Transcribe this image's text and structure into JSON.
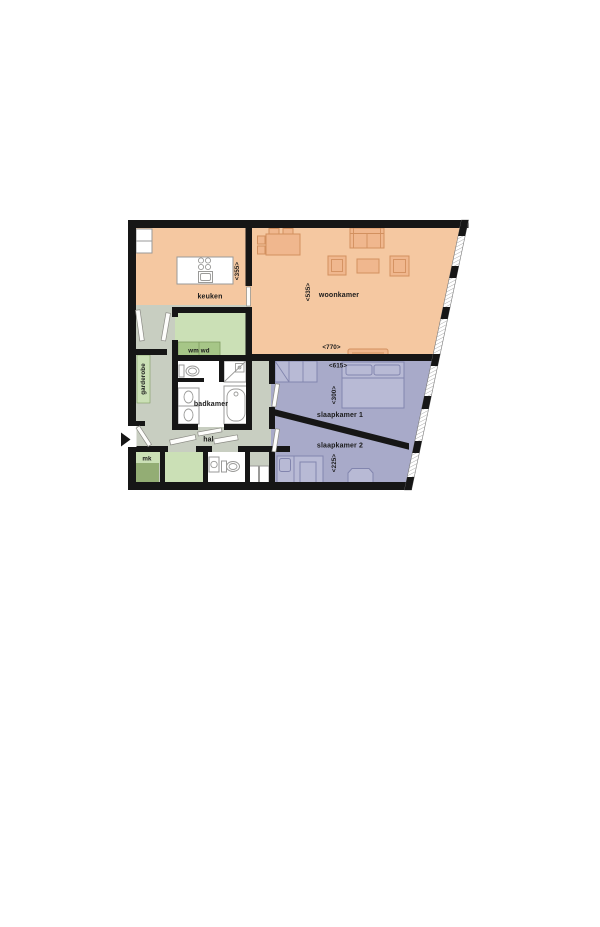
{
  "drawing": {
    "type": "apartment floor plan",
    "language": "Dutch"
  },
  "palette": {
    "wall": "#161616",
    "living": "#f5c8a1",
    "living_furniture": "#f0b78e",
    "bedroom": "#a8aac9",
    "bedroom_furniture": "#b8bad5",
    "hall": "#c8cec1",
    "utility_light": "#cbe0b6",
    "utility_mid": "#a6c687",
    "utility_dark": "#93ad74",
    "fixture_stroke": "#9a9a98",
    "text": "#1b1b1b",
    "background": "#ffffff"
  },
  "rooms": {
    "keuken": {
      "label": "keuken",
      "dim_depth": "<355>"
    },
    "woonkamer": {
      "label": "woonkamer",
      "dim_height": "<535>",
      "dim_width": "<770>"
    },
    "wm_wd": {
      "label": "wm wd"
    },
    "garderobe": {
      "label": "garderobe"
    },
    "badkamer": {
      "label": "badkamer"
    },
    "hal": {
      "label": "hal"
    },
    "mk": {
      "label": "mk"
    },
    "slaapkamer1": {
      "label": "slaapkamer 1",
      "dim_width": "<615>",
      "dim_height": "<300>"
    },
    "slaapkamer2": {
      "label": "slaapkamer 2",
      "dim_height": "<225>"
    }
  },
  "icons": {
    "entrance_arrow": "triangle pointing right at entrance door"
  }
}
